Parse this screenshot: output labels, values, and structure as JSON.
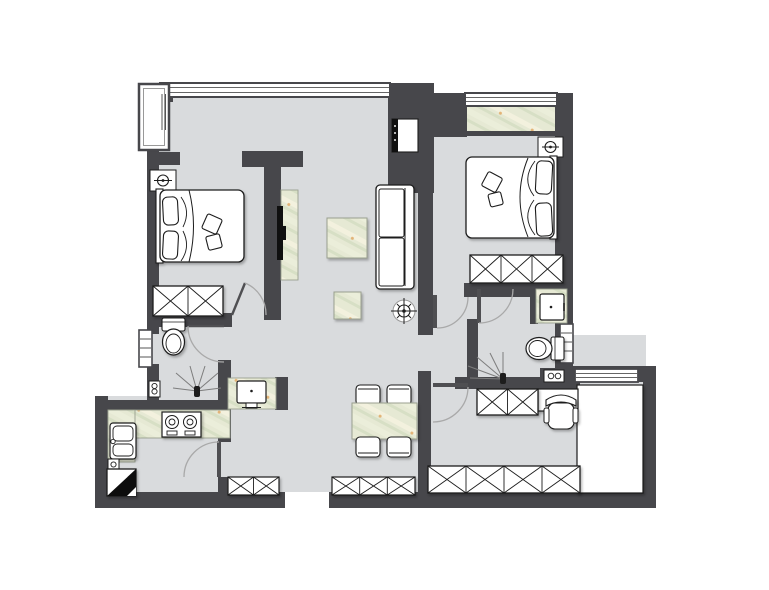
{
  "palette": {
    "background": "#ffffff",
    "wall": "#47474b",
    "floor": "#d9dbdd",
    "marble-base": "#e6e9d4",
    "marble-light": "#f3f1de",
    "marble-mid": "#ebeeda",
    "marble-dark": "#d7dfc5",
    "marble-accent": "#dfa055",
    "outline": "#1d1d1d",
    "door-arc": "#a9a9a9",
    "door-panel": "#4f4f52",
    "fixture": "#ffffff",
    "tv": "#101010",
    "marble-edge": "#9aa08f"
  },
  "plan": {
    "type": "apartment-floor-plan",
    "rooms": [
      {
        "name": "bedroom-1",
        "furniture": [
          "double-bed",
          "pillows",
          "ceiling-lamp",
          "wardrobe-2-section"
        ]
      },
      {
        "name": "living-room",
        "furniture": [
          "sofa",
          "coffee-table",
          "side-table",
          "tv-panel",
          "tv",
          "ceiling-light",
          "built-in-cabinet"
        ]
      },
      {
        "name": "bedroom-2",
        "furniture": [
          "double-bed",
          "pillows",
          "ceiling-lamp",
          "wardrobe-3-section"
        ]
      },
      {
        "name": "balcony",
        "furniture": []
      },
      {
        "name": "bathroom-1",
        "furniture": [
          "toilet",
          "shower-drain",
          "valve-box",
          "vanity-washbasin"
        ]
      },
      {
        "name": "kitchen",
        "furniture": [
          "l-shaped-counter",
          "double-sink",
          "gas-cooktop-2-burner",
          "refrigerator",
          "valve-box"
        ]
      },
      {
        "name": "dining-area",
        "furniture": [
          "dining-table",
          "chair",
          "chair",
          "chair",
          "chair"
        ]
      },
      {
        "name": "bathroom-2",
        "furniture": [
          "washbasin",
          "toilet",
          "shower-drain",
          "double-outlet-box"
        ]
      },
      {
        "name": "study",
        "furniture": [
          "l-shaped-desk",
          "office-chair",
          "wardrobe-2-section",
          "wardrobe-4-section"
        ]
      },
      {
        "name": "entry-hall",
        "furniture": [
          "shoe-cabinet-2-section",
          "shoe-cabinet-3-section"
        ]
      }
    ],
    "openings": [
      "bay-window",
      "top-window-band",
      "balcony-window",
      "bathroom-1-window",
      "bathroom-2-window",
      "study-window",
      "entry-opening"
    ],
    "doors": [
      "bedroom-1-door",
      "bathroom-1-door",
      "kitchen-door",
      "bedroom-2-door",
      "bathroom-2-door",
      "study-door"
    ]
  }
}
